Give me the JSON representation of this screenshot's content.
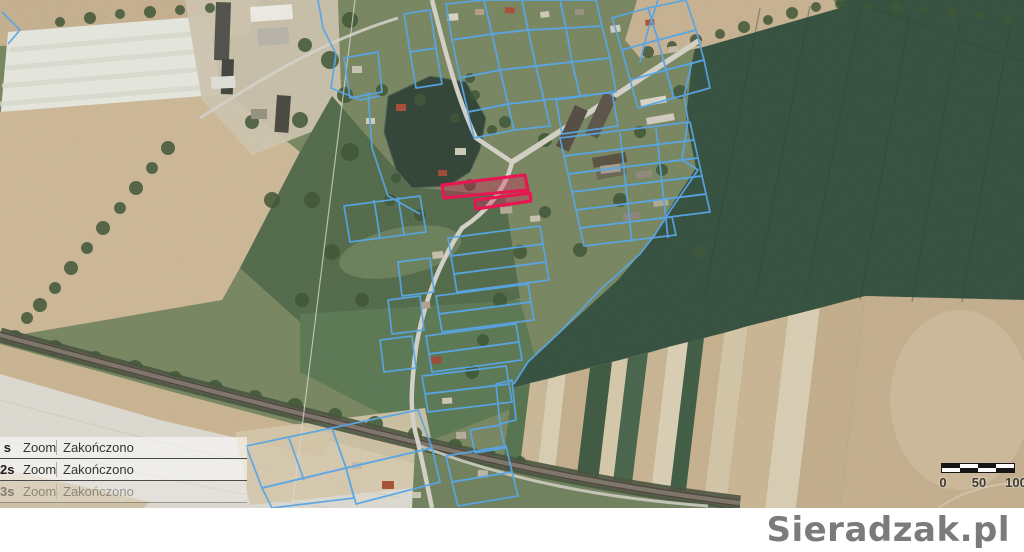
{
  "colors": {
    "highlight": "#e8114e",
    "highlight_fill": "rgba(228,24,86,0.32)",
    "parcel_outline": "#55a5e8"
  },
  "notifications": {
    "rows": [
      {
        "time": "s",
        "action": "Zoom",
        "status": "Zakończono"
      },
      {
        "time": "2s",
        "action": "Zoom",
        "status": "Zakończono"
      },
      {
        "time": "3s",
        "action": "Zoom",
        "status": "Zakończono"
      }
    ]
  },
  "scale_bar": {
    "labels": [
      "0",
      "50",
      "100"
    ]
  },
  "watermark": {
    "text": "Sieradzak.pl"
  }
}
